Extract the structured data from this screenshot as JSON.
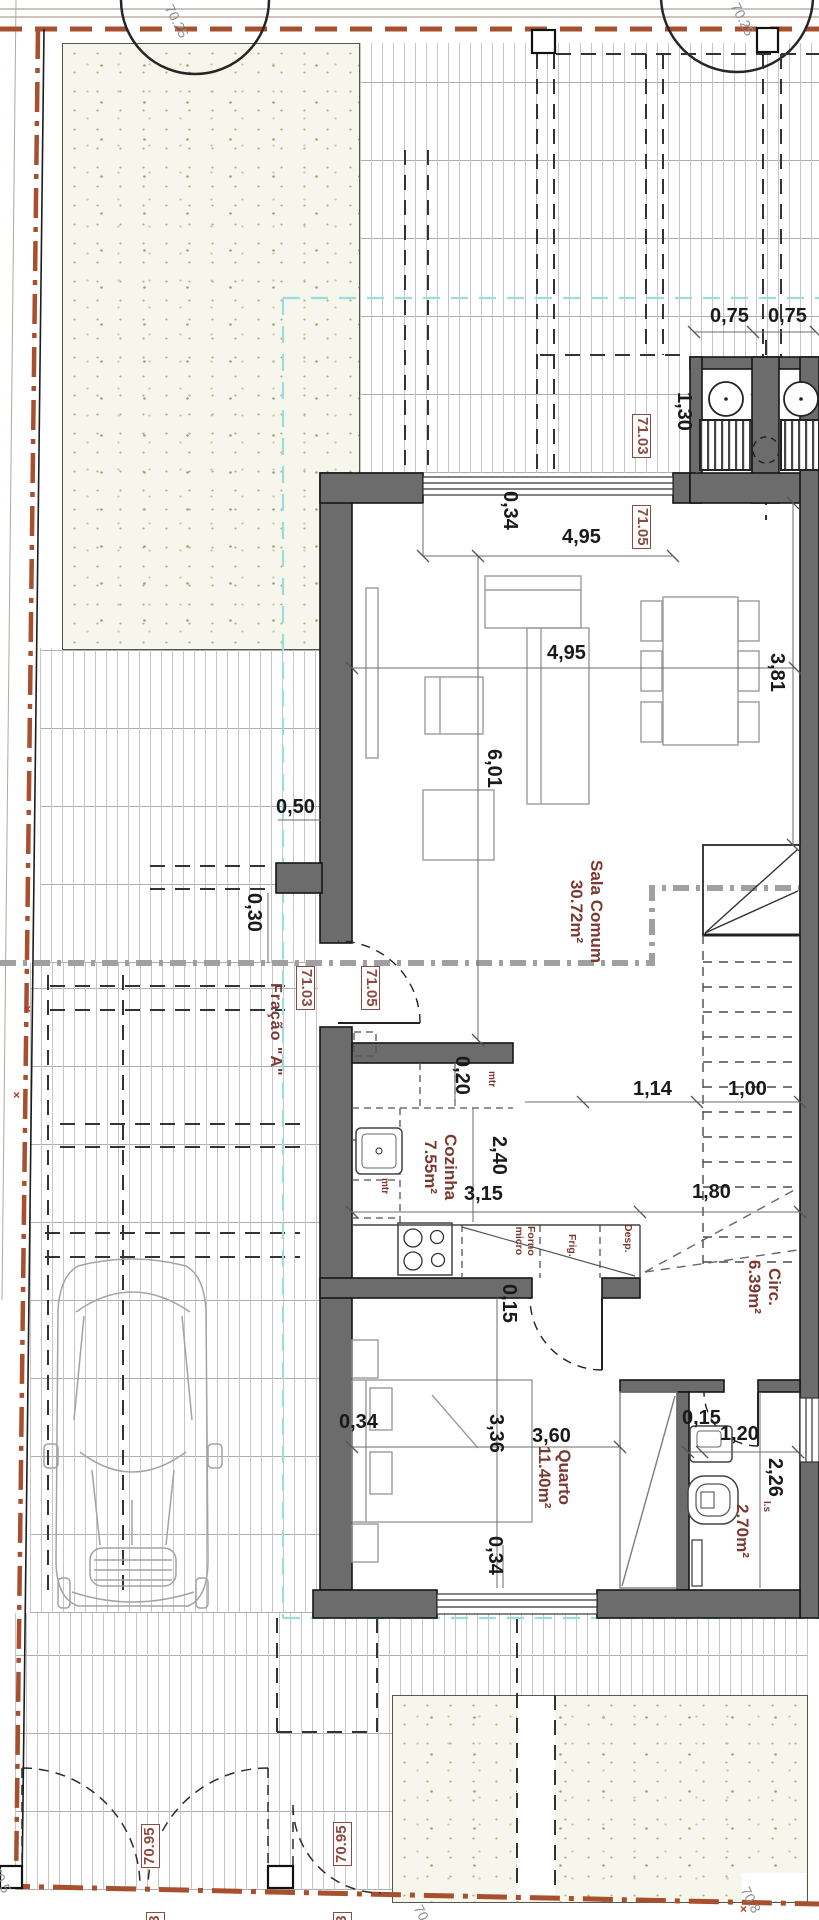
{
  "drawing": {
    "kind": "architectural ground-floor plan",
    "fraction": "Fração \"A\"",
    "rooms": [
      {
        "name": "Sala Comum",
        "area": "30.72m²"
      },
      {
        "name": "Cozinha",
        "area": "7.55m²"
      },
      {
        "name": "Quarto",
        "area": "11.40m²"
      },
      {
        "name": "Circ.",
        "area": "6.39m²"
      },
      {
        "name": "I.s",
        "area": "2.70m²"
      }
    ],
    "levels": [
      "70.25",
      "70.5",
      "70.8",
      "70.95",
      "71.03",
      "71.05"
    ],
    "colors": {
      "wall": "#6c6c6c",
      "boundary_red": "#a8502e",
      "level_maroon": "#8c4a40",
      "room_maroon": "#7c372f",
      "cyan_dashed": "#9ddcdc",
      "stipple_dot": "#b4b585"
    }
  },
  "labels": [
    {
      "t": "70.25",
      "x": 176,
      "y": 2,
      "r": 63,
      "c": "topo",
      "n": "tree-level-label"
    },
    {
      "t": "70.25",
      "x": 742,
      "y": 0,
      "r": 63,
      "c": "topo",
      "n": "tree-level-label"
    },
    {
      "t": "0,75",
      "x": 710,
      "y": 306,
      "r": 0,
      "c": "dim"
    },
    {
      "t": "0,75",
      "x": 768,
      "y": 306,
      "r": 0,
      "c": "dim"
    },
    {
      "t": "1,30",
      "x": 694,
      "y": 392,
      "r": 90,
      "c": "dim"
    },
    {
      "t": "71.03",
      "x": 651,
      "y": 414,
      "r": 90,
      "c": "lvl"
    },
    {
      "t": "0,34",
      "x": 520,
      "y": 491,
      "r": 90,
      "c": "dim"
    },
    {
      "t": "4,95",
      "x": 562,
      "y": 527,
      "r": 0,
      "c": "dim"
    },
    {
      "t": "71.05",
      "x": 651,
      "y": 505,
      "r": 90,
      "c": "lvl"
    },
    {
      "t": "4,95",
      "x": 547,
      "y": 643,
      "r": 0,
      "c": "dim"
    },
    {
      "t": "3,81",
      "x": 787,
      "y": 653,
      "r": 90,
      "c": "dim"
    },
    {
      "t": "6,01",
      "x": 504,
      "y": 749,
      "r": 90,
      "c": "dim"
    },
    {
      "t": "0,50",
      "x": 276,
      "y": 797,
      "r": 0,
      "c": "dim"
    },
    {
      "t": "0,30",
      "x": 264,
      "y": 893,
      "r": 90,
      "c": "dim"
    },
    {
      "t": "71.03",
      "x": 315,
      "y": 966,
      "r": 90,
      "c": "lvl"
    },
    {
      "t": "71.05",
      "x": 380,
      "y": 966,
      "r": 90,
      "c": "lvl"
    },
    {
      "t": "Fração \"A\"",
      "x": 284,
      "y": 983,
      "r": 90,
      "c": "frac",
      "n": "fraction-label"
    },
    {
      "t": "Sala Comum\n30.72m²",
      "x": 606,
      "y": 860,
      "r": 90,
      "c": "room",
      "n": "room-label-sala"
    },
    {
      "t": "1,14",
      "x": 633,
      "y": 1079,
      "r": 0,
      "c": "dim"
    },
    {
      "t": "1,00",
      "x": 728,
      "y": 1079,
      "r": 0,
      "c": "dim"
    },
    {
      "t": "0,20",
      "x": 472,
      "y": 1056,
      "r": 90,
      "c": "dim"
    },
    {
      "t": "mtr",
      "x": 497,
      "y": 1071,
      "r": 90,
      "c": "tiny"
    },
    {
      "t": "Cozinha\n7.55m²",
      "x": 460,
      "y": 1134,
      "r": 90,
      "c": "room",
      "n": "room-label-cozinha"
    },
    {
      "t": "2,40",
      "x": 509,
      "y": 1136,
      "r": 90,
      "c": "dim"
    },
    {
      "t": "3,15",
      "x": 464,
      "y": 1184,
      "r": 0,
      "c": "dim"
    },
    {
      "t": "mtr",
      "x": 390,
      "y": 1178,
      "r": 90,
      "c": "tiny"
    },
    {
      "t": "1,80",
      "x": 692,
      "y": 1182,
      "r": 0,
      "c": "dim"
    },
    {
      "t": "Forno\nmicro",
      "x": 536,
      "y": 1226,
      "r": 90,
      "c": "app",
      "n": "appliance-label-oven"
    },
    {
      "t": "Frig.",
      "x": 577,
      "y": 1234,
      "r": 90,
      "c": "app",
      "n": "appliance-label-fridge"
    },
    {
      "t": "Desp.",
      "x": 633,
      "y": 1224,
      "r": 90,
      "c": "app",
      "n": "appliance-label-pantry"
    },
    {
      "t": "0,15",
      "x": 519,
      "y": 1284,
      "r": 90,
      "c": "dim"
    },
    {
      "t": "Circ.\n6.39m²",
      "x": 784,
      "y": 1260,
      "r": 90,
      "c": "room",
      "n": "room-label-circ"
    },
    {
      "t": "0,34",
      "x": 339,
      "y": 1412,
      "r": 0,
      "c": "dim"
    },
    {
      "t": "3,36",
      "x": 506,
      "y": 1414,
      "r": 90,
      "c": "dim"
    },
    {
      "t": "3,60",
      "x": 532,
      "y": 1426,
      "r": 0,
      "c": "dim"
    },
    {
      "t": "Quarto\n11.40m²",
      "x": 574,
      "y": 1446,
      "r": 90,
      "c": "room",
      "n": "room-label-qu arto"
    },
    {
      "t": "0,34",
      "x": 505,
      "y": 1536,
      "r": 90,
      "c": "dim"
    },
    {
      "t": "0,15",
      "x": 682,
      "y": 1408,
      "r": 0,
      "c": "dim"
    },
    {
      "t": "1,20",
      "x": 720,
      "y": 1424,
      "r": 0,
      "c": "dim"
    },
    {
      "t": "2,26",
      "x": 785,
      "y": 1458,
      "r": 90,
      "c": "dim"
    },
    {
      "t": "I.s",
      "x": 772,
      "y": 1501,
      "r": 90,
      "c": "tiny",
      "n": "room-label-is"
    },
    {
      "t": "2.70m²",
      "x": 752,
      "y": 1504,
      "r": 90,
      "c": "room",
      "n": "room-label-bath-area"
    },
    {
      "t": "70.95",
      "x": 141,
      "y": 1868,
      "r": -90,
      "c": "lvl"
    },
    {
      "t": "70.95",
      "x": 333,
      "y": 1866,
      "r": -90,
      "c": "lvl"
    },
    {
      "t": "70.95",
      "x": 425,
      "y": 1902,
      "r": 63,
      "c": "topo"
    },
    {
      "t": "70.8",
      "x": 752,
      "y": 1884,
      "r": 63,
      "c": "topo"
    },
    {
      "t": "70.5",
      "x": 2,
      "y": 1864,
      "r": 63,
      "c": "topo"
    },
    {
      "t": "×",
      "x": 24,
      "y": 1002,
      "r": 0,
      "c": "mark",
      "n": "boundary-mark"
    },
    {
      "t": "×",
      "x": 13,
      "y": 1088,
      "r": 0,
      "c": "mark",
      "n": "boundary-mark"
    },
    {
      "t": "×",
      "x": 740,
      "y": 1902,
      "r": 0,
      "c": "mark",
      "n": "boundary-mark"
    },
    {
      "t": "71.03",
      "x": 146,
      "y": 1956,
      "r": -90,
      "c": "lvl"
    },
    {
      "t": "71.03",
      "x": 333,
      "y": 1956,
      "r": -90,
      "c": "lvl"
    }
  ]
}
